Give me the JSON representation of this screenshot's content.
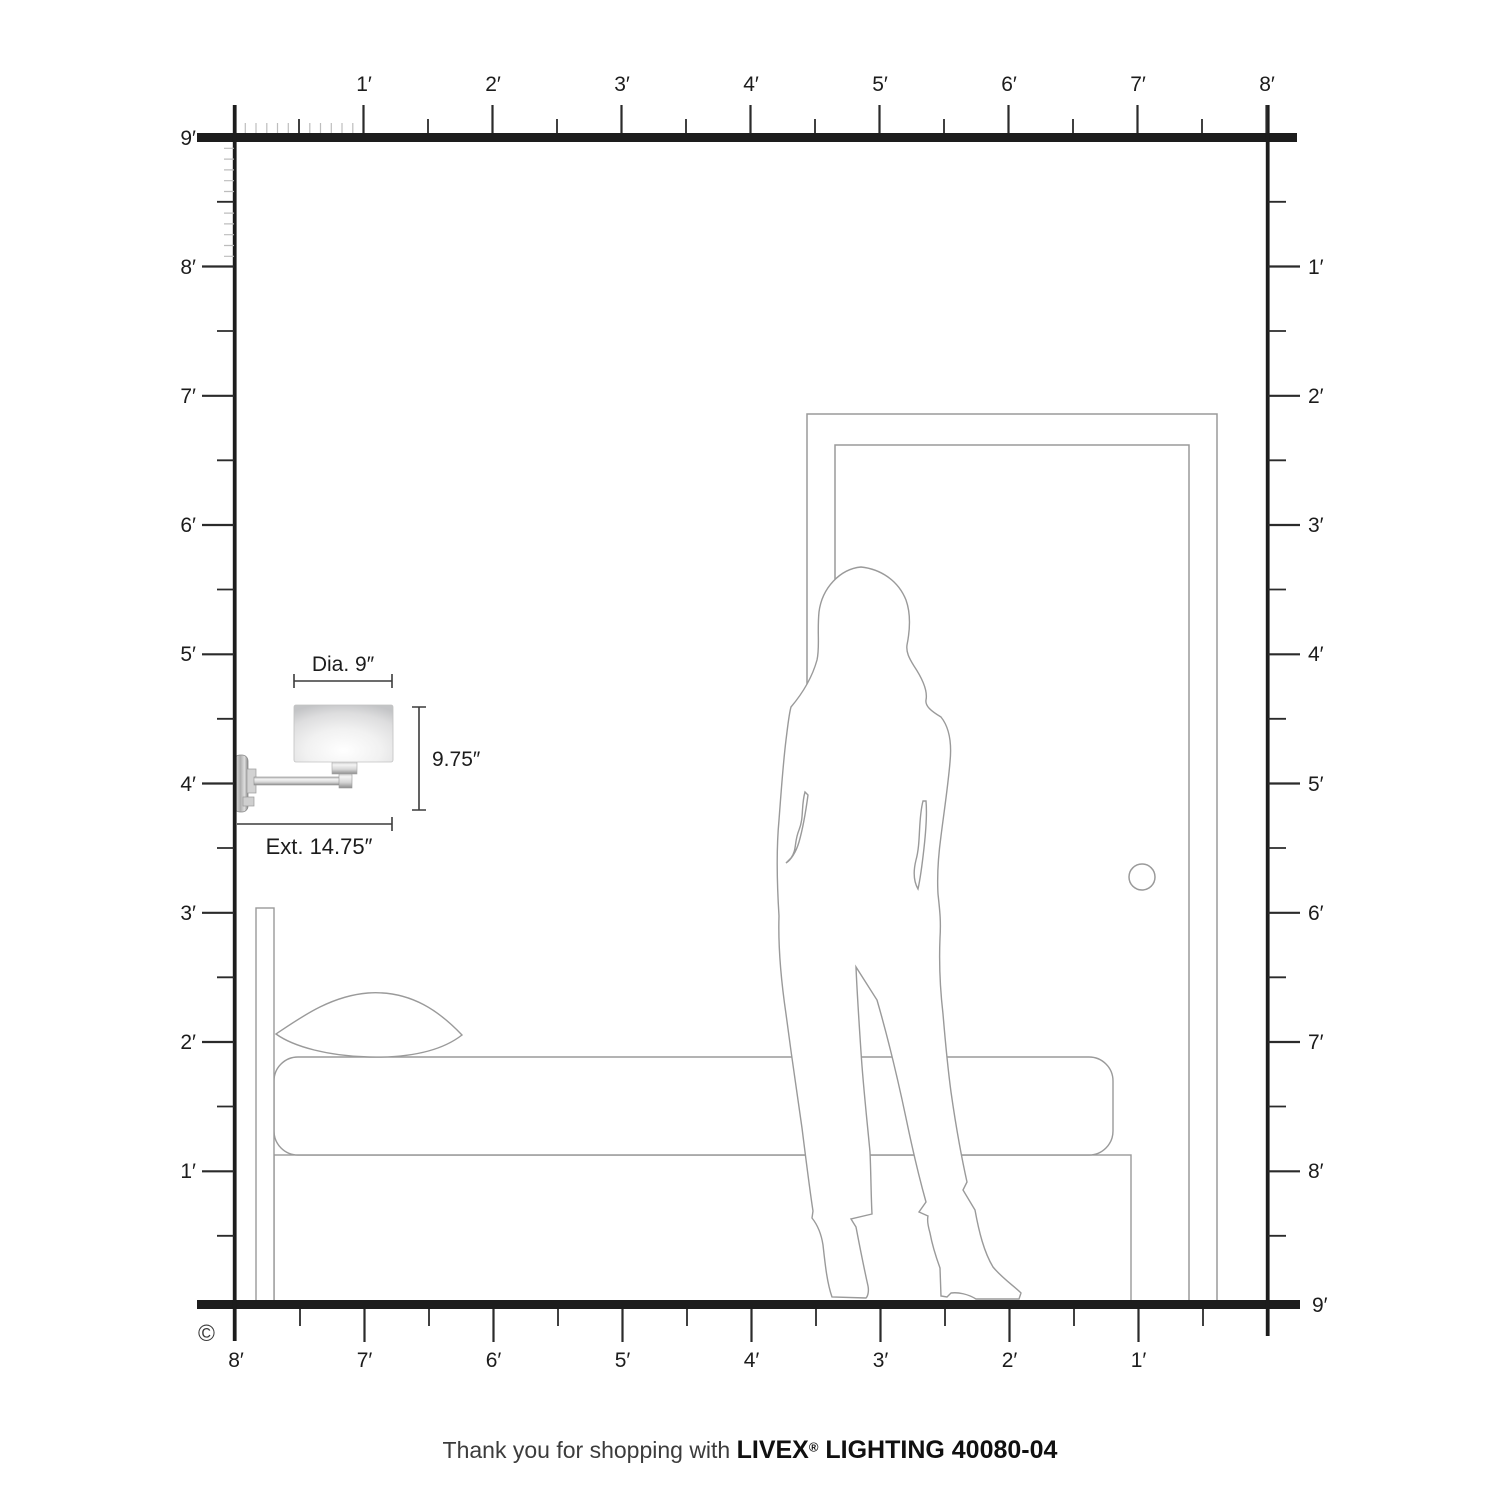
{
  "diagram": {
    "description": "Wall sconce mounting-height diagram with room scale rulers",
    "copyright_symbol": "©"
  },
  "rulers": {
    "unit": "feet",
    "top": {
      "labels": [
        "1′",
        "2′",
        "3′",
        "4′",
        "5′",
        "6′",
        "7′",
        "8′"
      ]
    },
    "left": {
      "labels": [
        "9′",
        "8′",
        "7′",
        "6′",
        "5′",
        "4′",
        "3′",
        "2′",
        "1′"
      ]
    },
    "right": {
      "labels": [
        "1′",
        "2′",
        "3′",
        "4′",
        "5′",
        "6′",
        "7′",
        "8′",
        "9′"
      ]
    },
    "bottom": {
      "labels": [
        "8′",
        "7′",
        "6′",
        "5′",
        "4′",
        "3′",
        "2′",
        "1′"
      ]
    }
  },
  "fixture": {
    "diameter_label": "Dia. 9″",
    "height_label": "9.75″",
    "extension_label": "Ext. 14.75″",
    "mounted_height_feet": 4
  },
  "scene_items": [
    "wall-sconce",
    "bed",
    "pillow",
    "headboard",
    "person",
    "door",
    "door-knob"
  ],
  "footer": {
    "prefix": "Thank you for shopping with ",
    "brand": "LIVEX",
    "registered": "®",
    "suffix": " LIGHTING 40080-04"
  },
  "colors": {
    "frame": "#1d1d1d",
    "tick_major": "#2b2b2b",
    "tick_minor": "#bdbdbd",
    "outline": "#9a9a9a",
    "text": "#1c1c1c"
  }
}
